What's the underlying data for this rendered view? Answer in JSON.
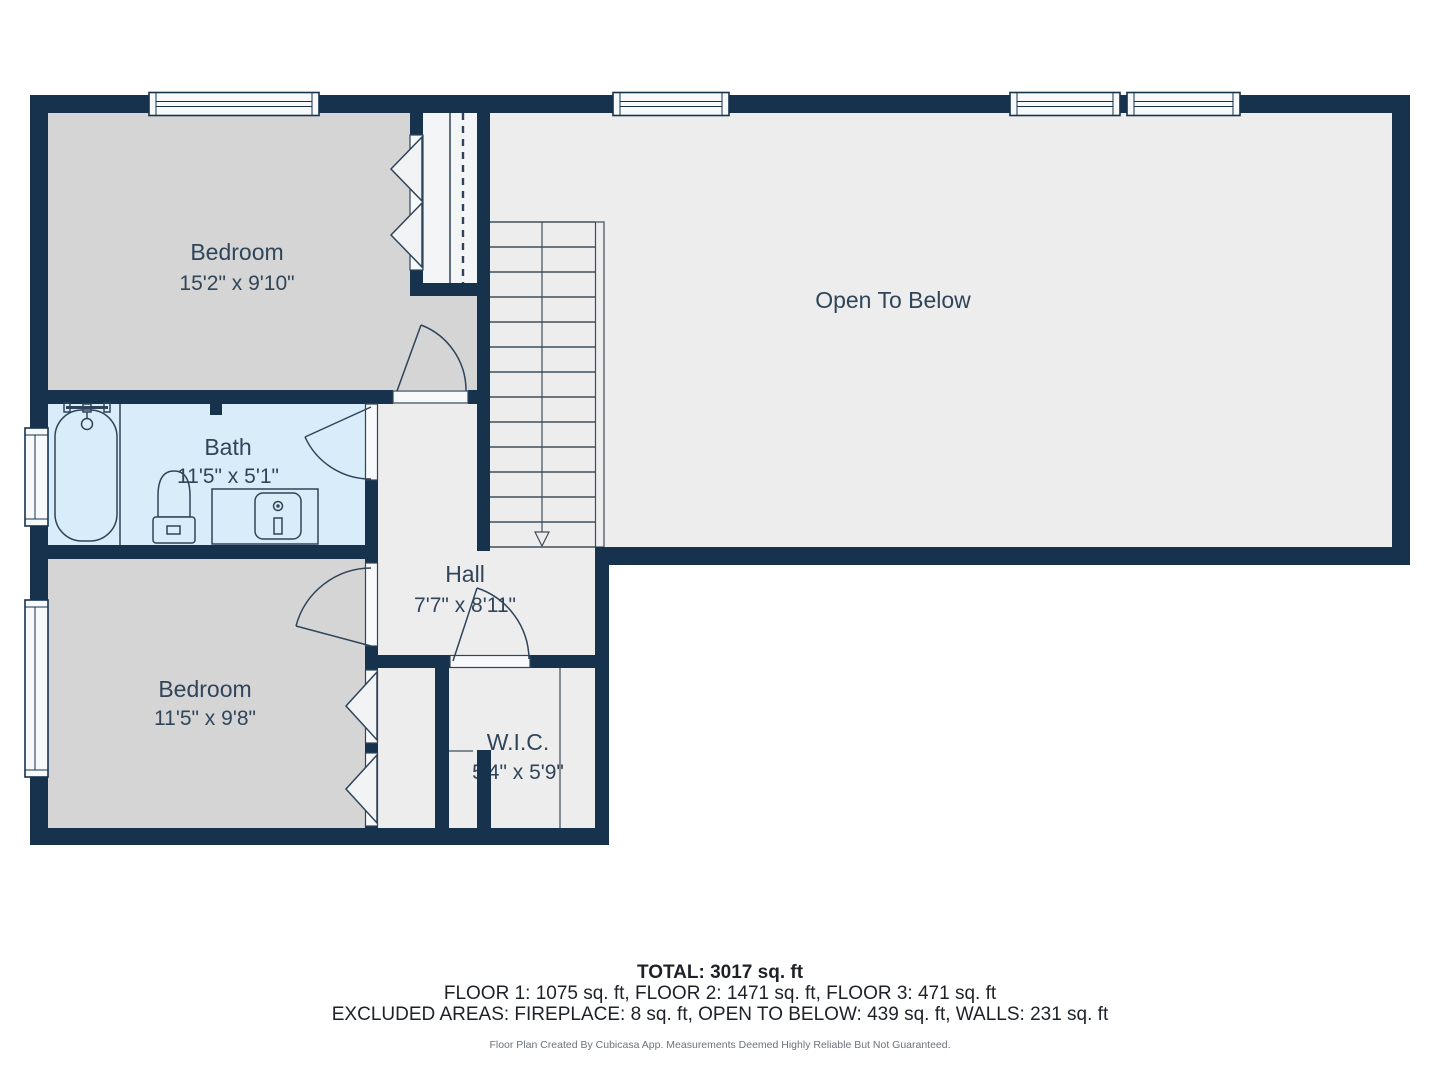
{
  "rooms": {
    "bedroom_top": {
      "label": "Bedroom",
      "dims": "15'2\" x 9'10\""
    },
    "open_to_below": {
      "label": "Open To Below"
    },
    "bath": {
      "label": "Bath",
      "dims": "11'5\" x 5'1\""
    },
    "hall": {
      "label": "Hall",
      "dims": "7'7\" x 8'11\""
    },
    "bedroom_bottom": {
      "label": "Bedroom",
      "dims": "11'5\" x 9'8\""
    },
    "wic": {
      "label": "W.I.C.",
      "dims": "5'4\" x 5'9\""
    }
  },
  "summary": {
    "total": "TOTAL: 3017 sq. ft",
    "floors": "FLOOR 1: 1075 sq. ft, FLOOR 2: 1471 sq. ft, FLOOR 3: 471 sq. ft",
    "excluded": "EXCLUDED AREAS: FIREPLACE: 8 sq. ft, OPEN TO BELOW: 439 sq. ft, WALLS: 231 sq. ft",
    "disclaimer": "Floor Plan Created By Cubicasa App. Measurements Deemed Highly Reliable But Not Guaranteed."
  },
  "colors": {
    "wall": "#16324D",
    "floor_room": "#D5D5D6",
    "floor_common": "#EDEDEE",
    "floor_bath": "#D8ECF9",
    "floor_closet": "#F4F5F6",
    "window": "#F7F9FB",
    "label_text": "#30455A"
  }
}
